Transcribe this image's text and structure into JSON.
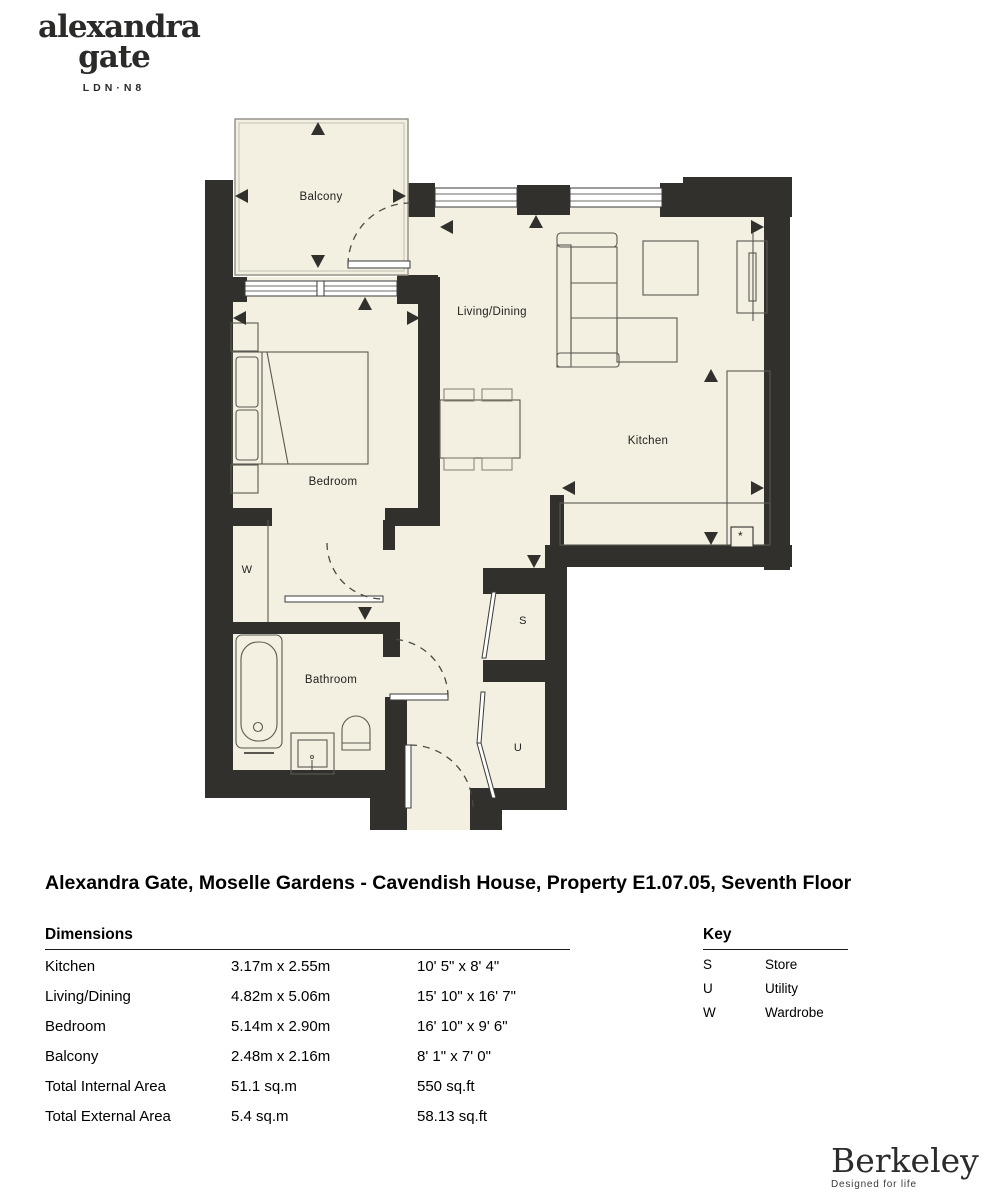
{
  "brand": {
    "logo_line1": "alexandra",
    "logo_line2": "gate",
    "logo_sub": "LDN·N8"
  },
  "plan": {
    "rooms": {
      "balcony": "Balcony",
      "living_dining": "Living/Dining",
      "kitchen": "Kitchen",
      "bedroom": "Bedroom",
      "bathroom": "Bathroom",
      "wardrobe": "W",
      "store": "S",
      "utility": "U",
      "asterisk": "*"
    }
  },
  "title": "Alexandra Gate, Moselle Gardens - Cavendish House, Property E1.07.05, Seventh Floor",
  "dimensions": {
    "heading": "Dimensions",
    "rows": [
      {
        "label": "Kitchen",
        "metric": "3.17m x 2.55m",
        "imperial": "10' 5\" x 8' 4\""
      },
      {
        "label": "Living/Dining",
        "metric": "4.82m x 5.06m",
        "imperial": "15' 10\" x 16' 7\""
      },
      {
        "label": "Bedroom",
        "metric": "5.14m x 2.90m",
        "imperial": "16' 10\" x 9' 6\""
      },
      {
        "label": "Balcony",
        "metric": "2.48m x 2.16m",
        "imperial": "8' 1\" x 7' 0\""
      },
      {
        "label": "Total Internal Area",
        "metric": "51.1 sq.m",
        "imperial": "550 sq.ft"
      },
      {
        "label": "Total External Area",
        "metric": "5.4 sq.m",
        "imperial": "58.13 sq.ft"
      }
    ]
  },
  "key": {
    "heading": "Key",
    "rows": [
      {
        "symbol": "S",
        "label": "Store"
      },
      {
        "symbol": "U",
        "label": "Utility"
      },
      {
        "symbol": "W",
        "label": "Wardrobe"
      }
    ]
  },
  "footer": {
    "brand": "Berkeley",
    "tagline": "Designed for life"
  }
}
